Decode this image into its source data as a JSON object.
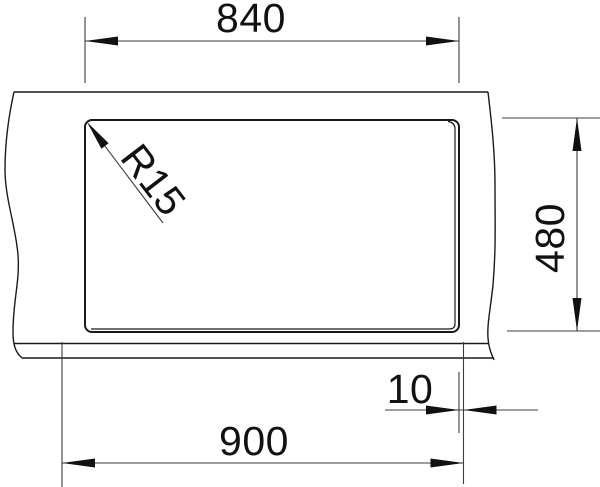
{
  "drawing": {
    "kind": "technical-dimension-drawing",
    "subject": "sink-cutout-plan-view",
    "background_color": "#ffffff",
    "line_color": "#1a1a1a",
    "dimension_line_color": "#3c3c3c",
    "text_color": "#111111",
    "dimensions": {
      "cutout_width": {
        "label": "840",
        "orientation": "horizontal-top"
      },
      "cutout_depth": {
        "label": "480",
        "orientation": "vertical-right"
      },
      "overall_width": {
        "label": "900",
        "orientation": "horizontal-bottom"
      },
      "edge_offset": {
        "label": "10",
        "orientation": "horizontal-bottom-small"
      },
      "corner_radius": {
        "label": "R15",
        "orientation": "diagonal-leader"
      }
    }
  }
}
